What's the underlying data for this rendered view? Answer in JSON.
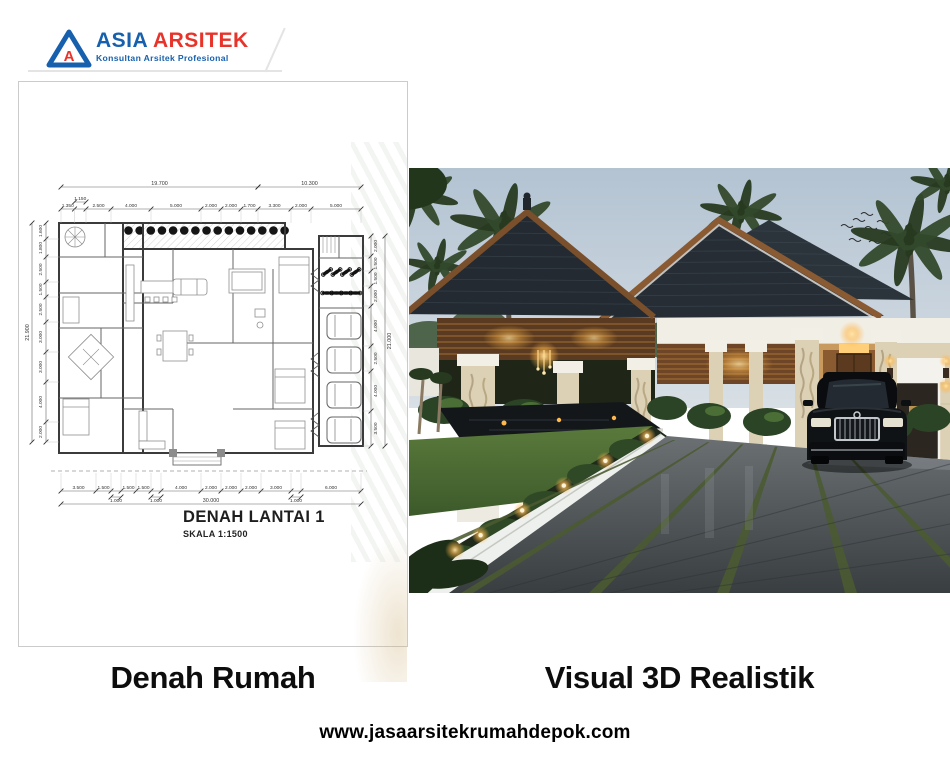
{
  "brand": {
    "name_primary": "ASIA",
    "name_secondary": "ARSITEK",
    "tagline": "Konsultan Arsitek Profesional",
    "monogram": "A",
    "color_blue": "#1660ad",
    "color_red": "#e8332a"
  },
  "plan": {
    "title": "DENAH LANTAI 1",
    "scale": "SKALA 1:1500",
    "chains": {
      "top_totals": [
        {
          "label": "19.700",
          "m": 19.7
        },
        {
          "label": "10.300",
          "m": 10.3
        }
      ],
      "top": [
        {
          "label": "1.350",
          "m": 1.35
        },
        {
          "label": "1.150",
          "m": 1.15,
          "raised": true
        },
        {
          "label": "2.500",
          "m": 2.5
        },
        {
          "label": "4.000",
          "m": 4.0
        },
        {
          "label": "5.000",
          "m": 5.0
        },
        {
          "label": "2.000",
          "m": 2.0
        },
        {
          "label": "2.000",
          "m": 2.0
        },
        {
          "label": "1.700",
          "m": 1.7
        },
        {
          "label": "3.300",
          "m": 3.3
        },
        {
          "label": "2.000",
          "m": 2.0
        },
        {
          "label": "5.000",
          "m": 5.0
        }
      ],
      "left": [
        {
          "label": "1.600",
          "m": 1.6
        },
        {
          "label": "1.800",
          "m": 1.8
        },
        {
          "label": "2.500",
          "m": 2.5
        },
        {
          "label": "1.500",
          "m": 1.5
        },
        {
          "label": "2.500",
          "m": 2.5
        },
        {
          "label": "3.000",
          "m": 3.0
        },
        {
          "label": "3.000",
          "m": 3.0
        },
        {
          "label": "4.000",
          "m": 4.0
        },
        {
          "label": "2.000",
          "m": 2.0
        }
      ],
      "left_total": "21.900",
      "right": [
        {
          "label": "2.000",
          "m": 2.0
        },
        {
          "label": "1.500",
          "m": 1.5
        },
        {
          "label": "1.500",
          "m": 1.5
        },
        {
          "label": "2.000",
          "m": 2.0
        },
        {
          "label": "4.000",
          "m": 4.0
        },
        {
          "label": "2.500",
          "m": 2.5
        },
        {
          "label": "4.000",
          "m": 4.0
        },
        {
          "label": "3.500",
          "m": 3.5
        }
      ],
      "right_total": "21.000",
      "bottom": [
        {
          "label": "3.500",
          "m": 3.5
        },
        {
          "label": "1.500",
          "m": 1.5
        },
        {
          "label": "1.000",
          "m": 1.0,
          "low": true
        },
        {
          "label": "1.500",
          "m": 1.5
        },
        {
          "label": "1.500",
          "m": 1.5
        },
        {
          "label": "1.000",
          "m": 1.0,
          "low": true
        },
        {
          "label": "4.000",
          "m": 4.0
        },
        {
          "label": "2.000",
          "m": 2.0
        },
        {
          "label": "2.000",
          "m": 2.0
        },
        {
          "label": "2.000",
          "m": 2.0
        },
        {
          "label": "3.000",
          "m": 3.0
        },
        {
          "label": "1.000",
          "m": 1.0,
          "low": true
        },
        {
          "label": "6.000",
          "m": 6.0
        }
      ],
      "bottom_total": "30.000"
    },
    "counts": {
      "pergola_trees": 15,
      "garage_cars": 4,
      "motorbikes": 8
    }
  },
  "captions": {
    "left": "Denah Rumah",
    "right": "Visual 3D Realistik"
  },
  "footer": {
    "website": "www.jasaarsitekrumahdepok.com"
  },
  "photo": {
    "subject": "tropical-villa-3d-render",
    "palette": {
      "sky": "#b6c6d4",
      "sky_low": "#d6dee4",
      "roof": "#262d34",
      "roof_back": "#2b333b",
      "wood": "#8a5a33",
      "slat": "#6e4526",
      "slat_line": "#b9823c",
      "stone": "#dcd0b5",
      "white_trim": "#f2efe7",
      "lawn": "#4e7034",
      "lawn_dark": "#3c5a2a",
      "foliage": "#33492b",
      "foliage_dark": "#273a20",
      "driveway": "#575c5f",
      "driveway_dark": "#3a3f42",
      "lane_grass": "#4b5a31",
      "accent_light": "#ffb84d",
      "car": "#101316",
      "pond": "#141719"
    },
    "counts": {
      "driveway_lanes": 6,
      "curb_lights": 6,
      "birds": 8,
      "palm_clusters": 6
    }
  }
}
